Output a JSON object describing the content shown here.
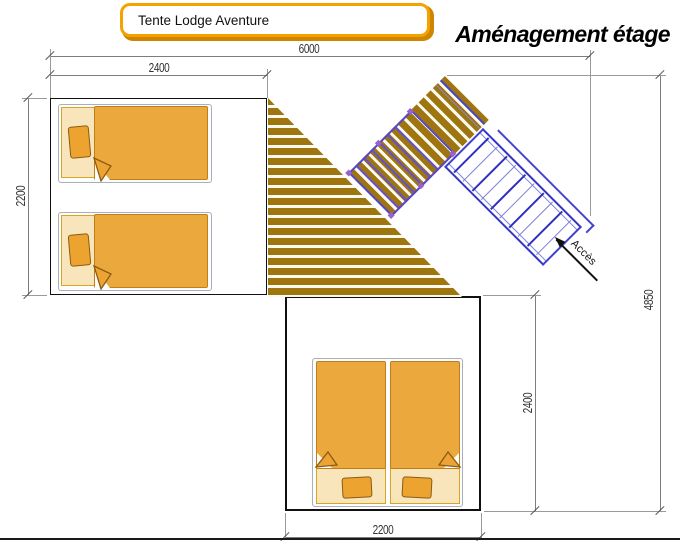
{
  "title_box": {
    "label": "Tente Lodge Aventure"
  },
  "heading": {
    "label": "Aménagement étage"
  },
  "dimensions": {
    "overall_width": "6000",
    "left_room_width": "2400",
    "left_room_depth": "2200",
    "overall_depth": "4850",
    "bottom_room_depth": "2400",
    "bottom_room_width": "2200"
  },
  "access": {
    "label": "Accès"
  },
  "colors": {
    "accent_orange": "#F5A201",
    "deck_wood": "#9E750E",
    "bed_blanket": "#EBA93D",
    "bed_sheet": "#F9E5BC",
    "ladder_blue": "#3434C4",
    "railing_purple": "#5646C8"
  }
}
